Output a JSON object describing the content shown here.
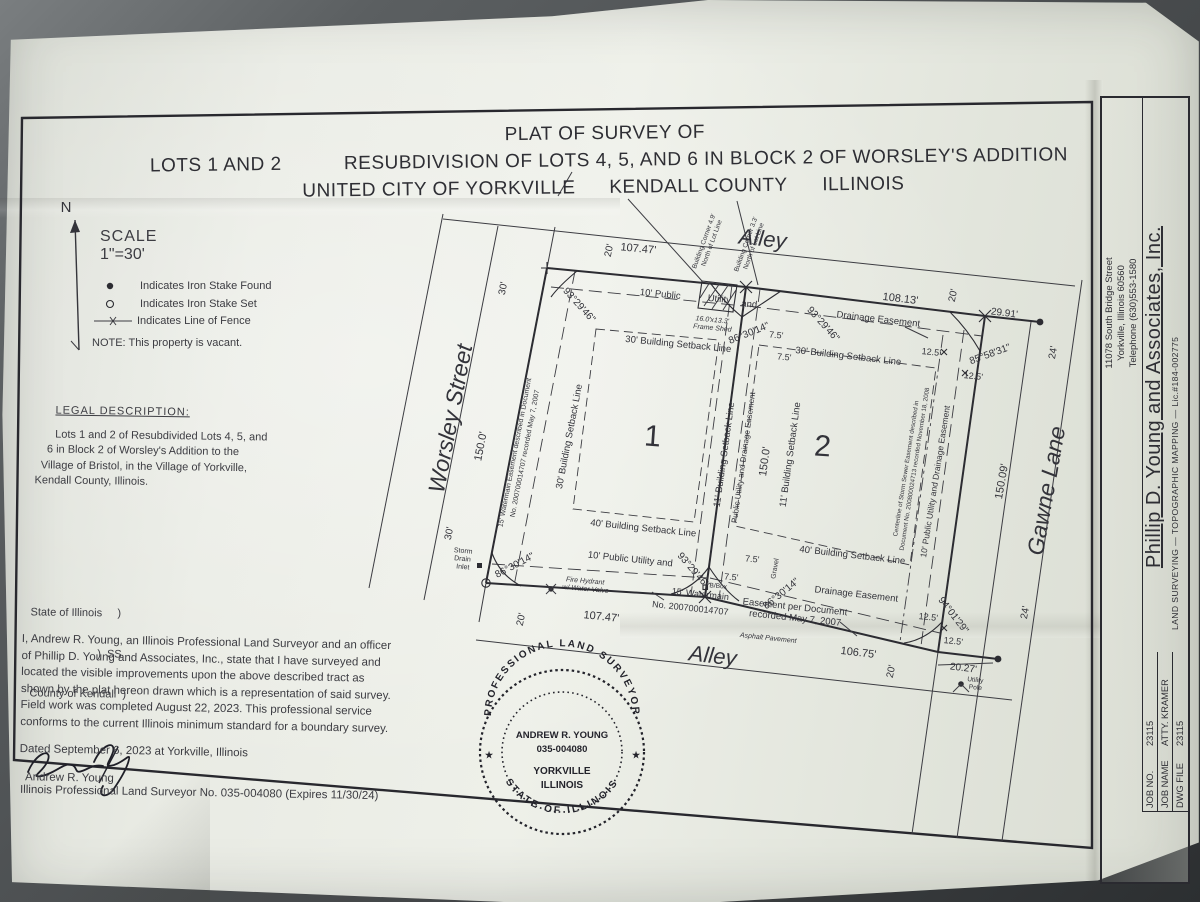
{
  "photo": {
    "backdrop": "#5b5f61",
    "paper": "#e8eae3",
    "ink": "#33333a"
  },
  "title": {
    "line1": "PLAT OF SURVEY OF",
    "line2_left": "LOTS 1 AND 2",
    "line2_right": "RESUBDIVISION OF LOTS 4, 5, AND 6 IN BLOCK 2 OF WORSLEY'S ADDITION",
    "line3_city": "UNITED CITY OF YORKVILLE",
    "line3_county": "KENDALL COUNTY",
    "line3_state": "ILLINOIS"
  },
  "compass": {
    "north_label": "N"
  },
  "scale": {
    "heading": "SCALE",
    "value": "1\"=30'"
  },
  "legend": {
    "items": [
      {
        "symbol": "iron-stake-found",
        "text": "Indicates Iron Stake Found"
      },
      {
        "symbol": "iron-stake-set",
        "text": "Indicates Iron Stake Set"
      },
      {
        "symbol": "line-of-fence",
        "text": "Indicates Line of Fence"
      }
    ],
    "note": "NOTE: This property is vacant."
  },
  "legal_description": {
    "heading": "LEGAL DESCRIPTION:",
    "lines": [
      "Lots 1 and 2 of Resubdivided Lots 4, 5, and",
      "6 in Block 2 of Worsley's Addition to the",
      "Village of Bristol, in the Village of Yorkville,",
      "Kendall County, Illinois."
    ]
  },
  "jurat": {
    "lines": [
      "State of Illinois     )",
      "                      )  SS",
      "County of Kendall  )"
    ]
  },
  "certificate": {
    "lines": [
      "I, Andrew R. Young, an Illinois Professional Land Surveyor and an officer",
      "of Phillip D. Young and Associates, Inc., state that I have surveyed and",
      "located the visible improvements upon the above described tract as",
      "shown by the plat hereon drawn which is a representation of said survey.",
      "Field work was completed August 22, 2023.   This professional service",
      "conforms to the current Illinois minimum standard for a boundary survey."
    ],
    "dated_line": "Dated September 6, 2023 at Yorkville, Illinois",
    "surveyor_name": "Andrew R. Young",
    "license_line": "Illinois Professional Land Surveyor No. 035-004080 (Expires 11/30/24)"
  },
  "seal": {
    "ring_top": "PROFESSIONAL LAND SURVEYOR",
    "ring_bottom": "STATE OF ILLINOIS",
    "name": "ANDREW R. YOUNG",
    "number": "035-004080",
    "city": "YORKVILLE",
    "state": "ILLINOIS",
    "star": "★"
  },
  "title_block": {
    "company": "Phillip D. Young and Associates, Inc.",
    "services": "LAND SURVEYING   —   TOPOGRAPHIC MAPPING   —   Lic.#184-002775",
    "address_lines": [
      "11078 South Bridge Street",
      "Yorkville, Illinois  60560",
      "Telephone (630)553-1580"
    ],
    "jobs": [
      {
        "label": "JOB NO.",
        "value": "23115"
      },
      {
        "label": "JOB NAME",
        "value": "ATTY. KRAMER"
      },
      {
        "label": "DWG FILE",
        "value": "23115"
      }
    ]
  },
  "plat": {
    "roads": {
      "alley": "Alley",
      "worsley": "Worsley Street",
      "gawne": "Gawne Lane"
    },
    "lots": {
      "lot1": "1",
      "lot2": "2"
    },
    "dims": {
      "top_lot1": "107.47'",
      "top_lot2": "108.13'",
      "bottom_lot1": "107.47'",
      "bottom_lot2": "106.75'",
      "west_lot1": "150.0'",
      "center": "150.0'",
      "east_lot2": "150.09'",
      "ext_29_91": "29.91'",
      "ext_20_27": "20.27'",
      "w20": "20'",
      "w30": "30'",
      "w24": "24'",
      "d7_5": "7.5'",
      "d12_5": "12.5'"
    },
    "angles": {
      "a93": "93°29'46\"",
      "a86": "86°30'14\"",
      "a85": "85°58'31\"",
      "a94": "94°01'29\""
    },
    "setbacks": {
      "sb30": "30' Building Setback Line",
      "sb11": "11' Building Setback Line",
      "sb40": "40' Building Setback Line"
    },
    "easements": {
      "pu10_a": "10' Public",
      "pu10_b": "Utility",
      "pu10_c": "and",
      "pu10": "10' Public Utility and",
      "drainage": "Drainage Easement",
      "pude_center": "Public Utility and Drainage Easement",
      "pude_east": "10' Public Utility and Drainage Easement",
      "wm_west_1": "15' Watermain Easement described in Document",
      "wm_west_2": "No. 200700014707 recorded May 7, 2007",
      "wm_bot_1": "15' Watermain",
      "wm_bot_2": "No. 200700014707",
      "ease_doc_1": "Easement per Document",
      "ease_doc_2": "recorded May 7, 2007",
      "storm_1": "Centerline of Storm Sewer Easement described in",
      "storm_2": "Document No. 200800024713 recorded November 18, 2008"
    },
    "annotations": {
      "bc49": "Building Corner 4.9'",
      "bc33": "Building Corner 3.3'",
      "bc_sub": "North of Lot Line",
      "shed_1": "16.0'x13.3'",
      "shed_2": "Frame Shed",
      "inlet_1": "Storm",
      "inlet_2": "Drain",
      "inlet_3": "Inlet",
      "fire_1": "Fire Hydrant",
      "fire_2": "w/ Water Valve",
      "bbox": "B/Box",
      "gravel": "Gravel",
      "asphalt": "Asphalt Pavement",
      "pole_1": "Utility",
      "pole_2": "Pole"
    }
  }
}
